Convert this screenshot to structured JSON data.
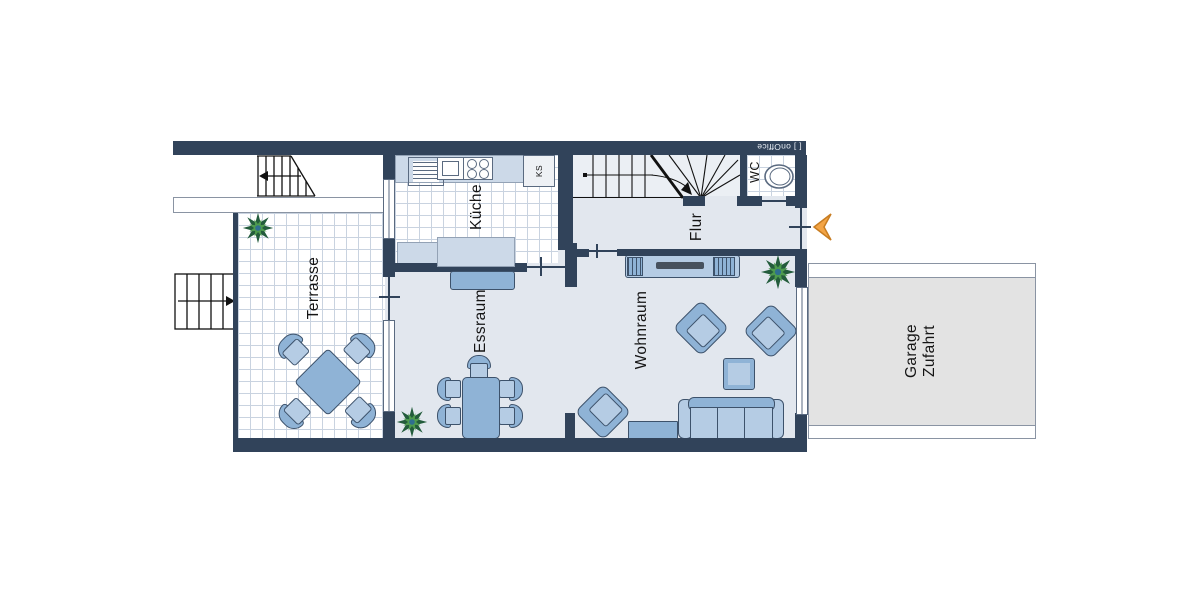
{
  "branding": {
    "logo": "[ ] onOffice"
  },
  "rooms": {
    "terrasse": {
      "label": "Terrasse"
    },
    "kueche": {
      "label": "Küche"
    },
    "essraum": {
      "label": "Essraum"
    },
    "flur": {
      "label": "Flur"
    },
    "wc": {
      "label": "WC"
    },
    "wohnraum": {
      "label": "Wohnraum"
    },
    "garage": {
      "line1": "Garage",
      "line2": "Zufahrt"
    }
  },
  "labels": {
    "fridge": "KS"
  },
  "colors": {
    "wall": "#31435a",
    "floor": "#e2e7ee",
    "tile_line": "#c9d3e0",
    "furniture": "#b5cce4",
    "furniture_dark": "#8fb3d6",
    "furniture_border": "#3d526b",
    "counter": "#ccd9e8",
    "garage_fill": "#e3e3e3",
    "arrow": "#f3a445",
    "plant_dark": "#235c3c",
    "plant_light": "#4e9b4e"
  }
}
